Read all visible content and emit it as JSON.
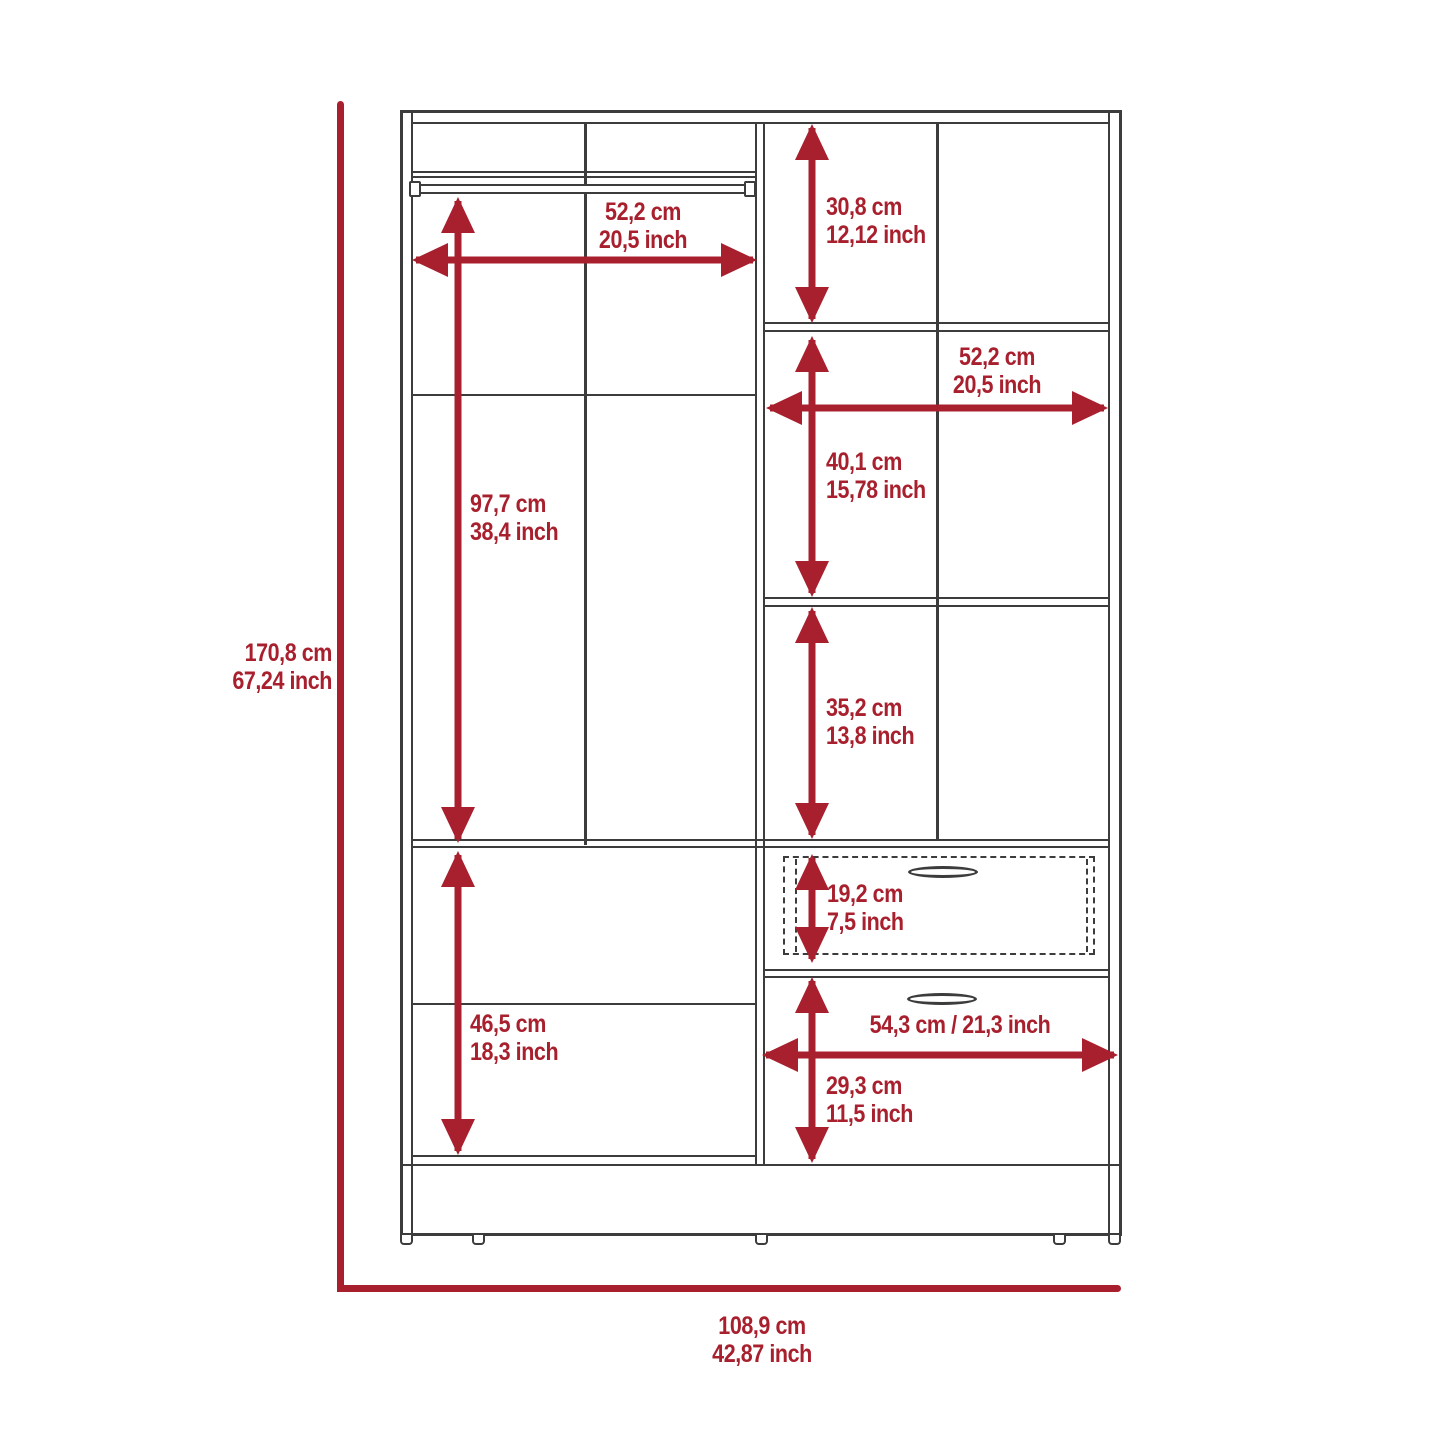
{
  "diagram": {
    "title": "wardrobe-dimensions-diagram",
    "accent_color": "#a8202e",
    "line_color": "#3c3c3c",
    "overall": {
      "height": {
        "cm": "170,8 cm",
        "inch": "67,24 inch"
      },
      "width": {
        "cm": "108,9 cm",
        "inch": "42,87 inch"
      }
    },
    "dimensions": {
      "hang_width": {
        "cm": "52,2 cm",
        "inch": "20,5 inch"
      },
      "left_height": {
        "cm": "97,7 cm",
        "inch": "38,4 inch"
      },
      "top_right_height": {
        "cm": "30,8 cm",
        "inch": "12,12 inch"
      },
      "right_width": {
        "cm": "52,2 cm",
        "inch": "20,5 inch"
      },
      "mid_right_height": {
        "cm": "40,1 cm",
        "inch": "15,78 inch"
      },
      "lower_right_height": {
        "cm": "35,2 cm",
        "inch": "13,8 inch"
      },
      "drawer1_height": {
        "cm": "19,2 cm",
        "inch": "7,5 inch"
      },
      "left_lower_height": {
        "cm": "46,5 cm",
        "inch": "18,3 inch"
      },
      "drawer2_width": {
        "combined": "54,3 cm / 21,3 inch"
      },
      "drawer2_height": {
        "cm": "29,3 cm",
        "inch": "11,5 inch"
      }
    }
  }
}
